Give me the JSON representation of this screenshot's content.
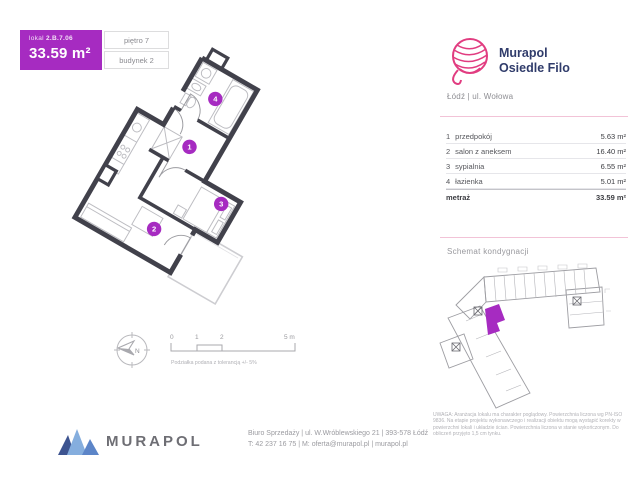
{
  "unit": {
    "lokal_label": "lokal",
    "lokal_value": "2.B.7.06",
    "area": "33.59 m²",
    "floor": "piętro 7",
    "building": "budynek 2"
  },
  "project": {
    "brand": "Murapol",
    "name": "Osiedle Filo",
    "location": "Łódź | ul. Wołowa"
  },
  "rooms": {
    "rows": [
      {
        "no": "1",
        "name": "przedpokój",
        "area": "5.63 m²"
      },
      {
        "no": "2",
        "name": "salon z aneksem",
        "area": "16.40 m²"
      },
      {
        "no": "3",
        "name": "sypialnia",
        "area": "6.55 m²"
      },
      {
        "no": "4",
        "name": "łazienka",
        "area": "5.01 m²"
      }
    ],
    "total_label": "metraż",
    "total_value": "33.59 m²"
  },
  "plan": {
    "markers": {
      "m1": "1",
      "m2": "2",
      "m3": "3",
      "m4": "4"
    },
    "north": "N",
    "scale": {
      "t0": "0",
      "t1": "1",
      "t2": "2",
      "t3": "5 m"
    },
    "scale_note": "Podziałka podana z tolerancją +/- 5%"
  },
  "schematic": {
    "title": "Schemat kondygnacji"
  },
  "disclaimer": "UWAGA: Aranżacja lokalu ma charakter poglądowy. Powierzchnia liczona wg PN-ISO 9836. Na etapie projektu wykonawczego i realizacji obiektu mogą wystąpić korekty w powierzchni lokali i układzie ścian. Powierzchnia liczona w stanie wykończonym. Do obliczeń przyjęto 1,5 cm tynku.",
  "footer": {
    "brand": "MURAPOL",
    "line1": "Biuro Sprzedaży | ul. W.Wróblewskiego 21 | 393-578 Łódź",
    "line2": "T: 42 237 16 75 | M: oferta@murapol.pl | murapol.pl"
  },
  "colors": {
    "accent_purple": "#a62bc1",
    "brand_navy": "#303c6b",
    "brand_pink": "#e13c80",
    "wall_dark": "#41414b",
    "divider_pink": "#f2c3d7"
  }
}
